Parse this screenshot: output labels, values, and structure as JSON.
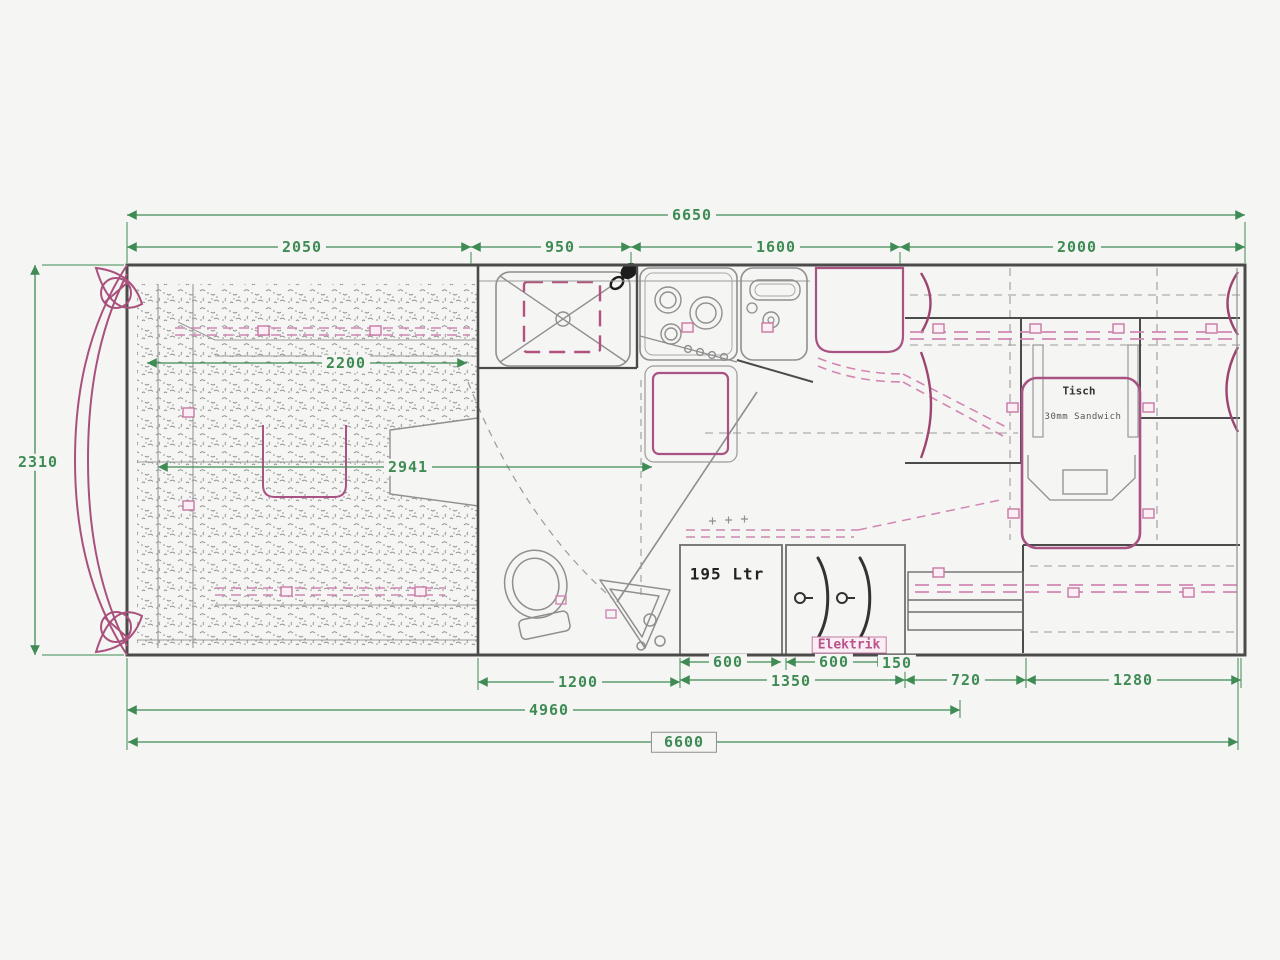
{
  "drawing": {
    "type": "motorhome-floor-plan",
    "colors": {
      "dimension_green": "#3e8b54",
      "wall_ink": "#4b4b4b",
      "furniture_gray": "#8f8f8f",
      "accent_magenta": "#a85383",
      "accent_pink_dashed": "#d286b2",
      "background": "#f5f5f3"
    },
    "dimensions_mm": {
      "overall_top": "6650",
      "overall_bottom": "6600",
      "overall_width": "2310",
      "seg_rear_bed": "2050",
      "seg_bathroom": "950",
      "seg_kitchen": "1600",
      "seg_dinette": "2000",
      "bed_length": "2200",
      "interior_span": "2941",
      "tank_width": "600",
      "wardrobe_width": "600",
      "gap_width": "150",
      "tank_wardrobe_total": "1350",
      "bathroom_floor": "1200",
      "drawer_unit": "720",
      "rear_bench": "1280",
      "rear_section": "4960"
    },
    "labels": {
      "water_tank": "195 Ltr",
      "electrics": "Elektrik",
      "table": "Tisch",
      "table_note": "30mm Sandwich"
    }
  }
}
